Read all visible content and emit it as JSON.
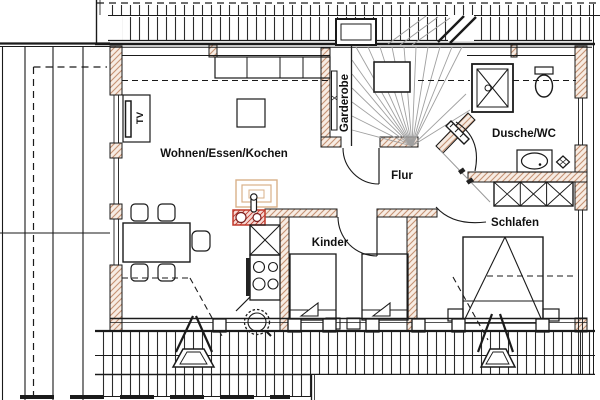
{
  "floor_plan": {
    "room_labels": {
      "living": "Wohnen/Essen/Kochen",
      "hall": "Flur",
      "children": "Kinder",
      "bedroom": "Schlafen",
      "bath": "Dusche/WC",
      "wardrobe": "Garderobe"
    },
    "fixture_labels": {
      "tv": "TV"
    },
    "colors": {
      "line": "#1a1a1a",
      "wall_hatch": "#c69273",
      "wall_fill": "#f7ece3",
      "stove_red": "#c0392b",
      "stove_fill": "#f6d9d4",
      "chimney_faint": "#d9b089",
      "stair_line": "#a0a0a0",
      "background": "#ffffff"
    }
  }
}
